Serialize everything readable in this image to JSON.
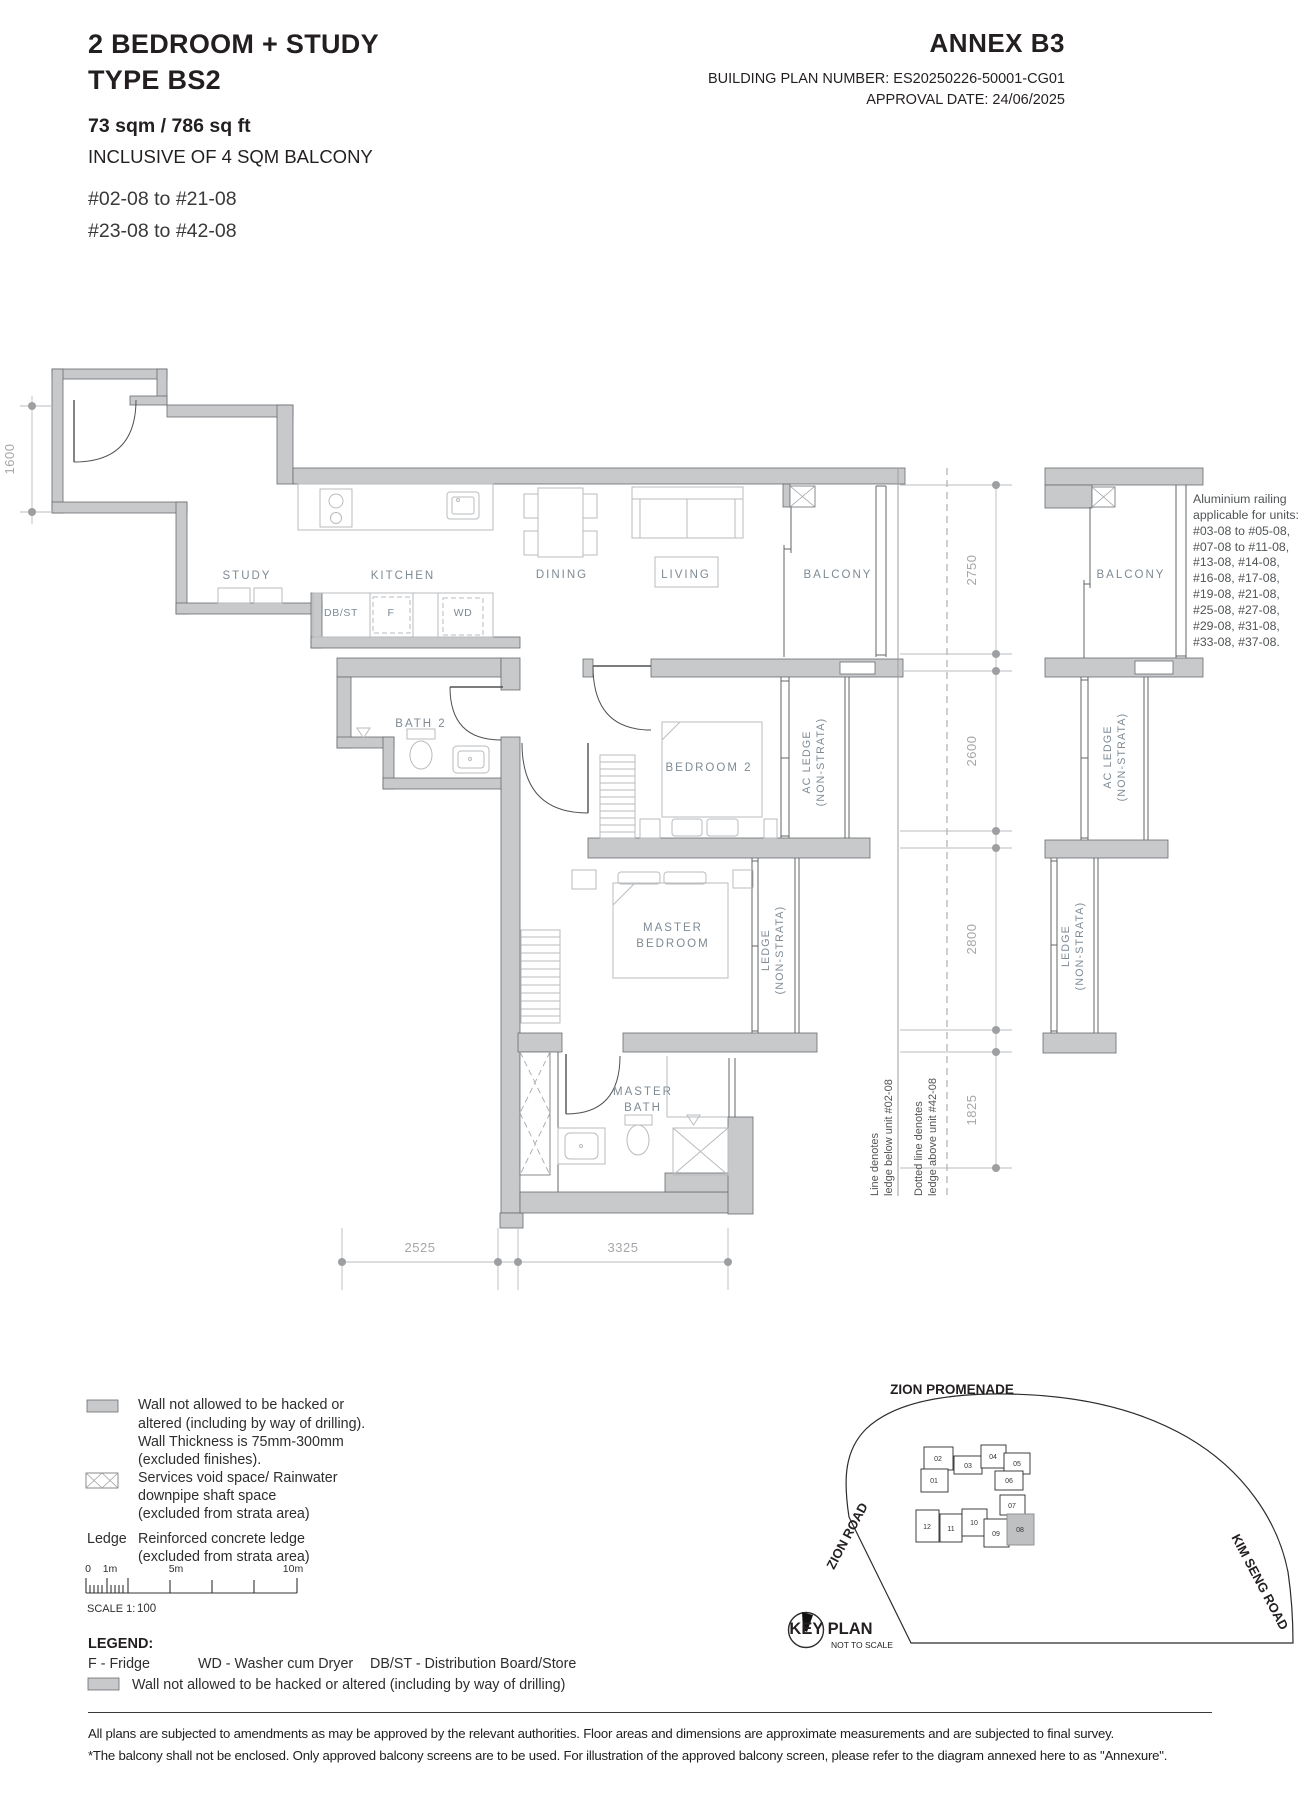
{
  "header": {
    "title_line1": "2 BEDROOM + STUDY",
    "title_line2": "TYPE BS2",
    "area": "73 sqm / 786 sq ft",
    "inclusive": "INCLUSIVE OF 4 SQM BALCONY",
    "floors_line1": "#02-08 to #21-08",
    "floors_line2": "#23-08 to #42-08",
    "annex": "ANNEX B3",
    "building_plan": "BUILDING PLAN NUMBER: ES20250226-50001-CG01",
    "approval": "APPROVAL DATE: 24/06/2025"
  },
  "plan": {
    "study": "STUDY",
    "kitchen": "KITCHEN",
    "dining": "DINING",
    "living": "LIVING",
    "balcony": "BALCONY",
    "bath2": "BATH 2",
    "bedroom2": "BEDROOM 2",
    "master": "MASTER",
    "bedroom": "BEDROOM",
    "bath": "BATH",
    "acledge": "AC LEDGE",
    "ledge": "LEDGE",
    "nonstrata": "(NON-STRATA)",
    "dbst": "DB/ST",
    "f": "F",
    "wd": "WD"
  },
  "dims": {
    "left": "1600",
    "right": [
      "2750",
      "2600",
      "2800",
      "1825"
    ],
    "bottom": [
      "2525",
      "3325"
    ]
  },
  "notes": {
    "solid1": "Line denotes",
    "solid2": "ledge below unit #02-08",
    "dotted1": "Dotted line denotes",
    "dotted2": "ledge above unit #42-08",
    "railing": [
      "Aluminium railing",
      "applicable for units:",
      "#03-08 to #05-08,",
      "#07-08 to #11-08,",
      "#13-08, #14-08,",
      "#16-08, #17-08,",
      "#19-08, #21-08,",
      "#25-08, #27-08,",
      "#29-08, #31-08,",
      "#33-08, #37-08."
    ]
  },
  "legend": {
    "wall_lines": [
      "Wall not allowed to be hacked or",
      "altered (including by way of drilling).",
      "Wall Thickness is 75mm-300mm",
      "(excluded finishes)."
    ],
    "services_lines": [
      "Services void space/ Rainwater",
      "downpipe shaft space",
      "(excluded from strata area)"
    ],
    "ledge_term": "Ledge",
    "ledge_lines": [
      "Reinforced concrete ledge",
      "(excluded from strata area)"
    ],
    "scale_ticks": [
      "0",
      "1m",
      "5m",
      "10m"
    ],
    "scale_label": "SCALE 1:",
    "scale_value": "100"
  },
  "legend_line": {
    "heading": "LEGEND:",
    "items": [
      "F - Fridge",
      "WD - Washer cum Dryer",
      "DB/ST - Distribution Board/Store"
    ],
    "wall_note": "Wall not allowed to be hacked or altered (including by way of drilling)"
  },
  "key_plan": {
    "title": "KEY PLAN",
    "subtitle": "NOT TO SCALE",
    "road_top": "ZION PROMENADE",
    "road_left": "ZION ROAD",
    "road_right": "KIM SENG ROAD",
    "units": [
      "01",
      "02",
      "03",
      "04",
      "05",
      "06",
      "07",
      "08",
      "09",
      "10",
      "11",
      "12"
    ],
    "highlighted_unit": "08"
  },
  "footer": {
    "line1": "All plans are subjected to amendments as may be approved by the relevant authorities. Floor areas and dimensions are approximate measurements and are subjected to final survey.",
    "line2": "*The balcony shall not be enclosed. Only approved balcony screens are to be used. For illustration of the approved balcony screen, please refer to the diagram annexed here to as \"Annexure\"."
  },
  "colors": {
    "wall_fill": "#c8c9ca",
    "label": "#7e8a94",
    "dim": "#a4a7aa",
    "ink": "#231f20"
  }
}
